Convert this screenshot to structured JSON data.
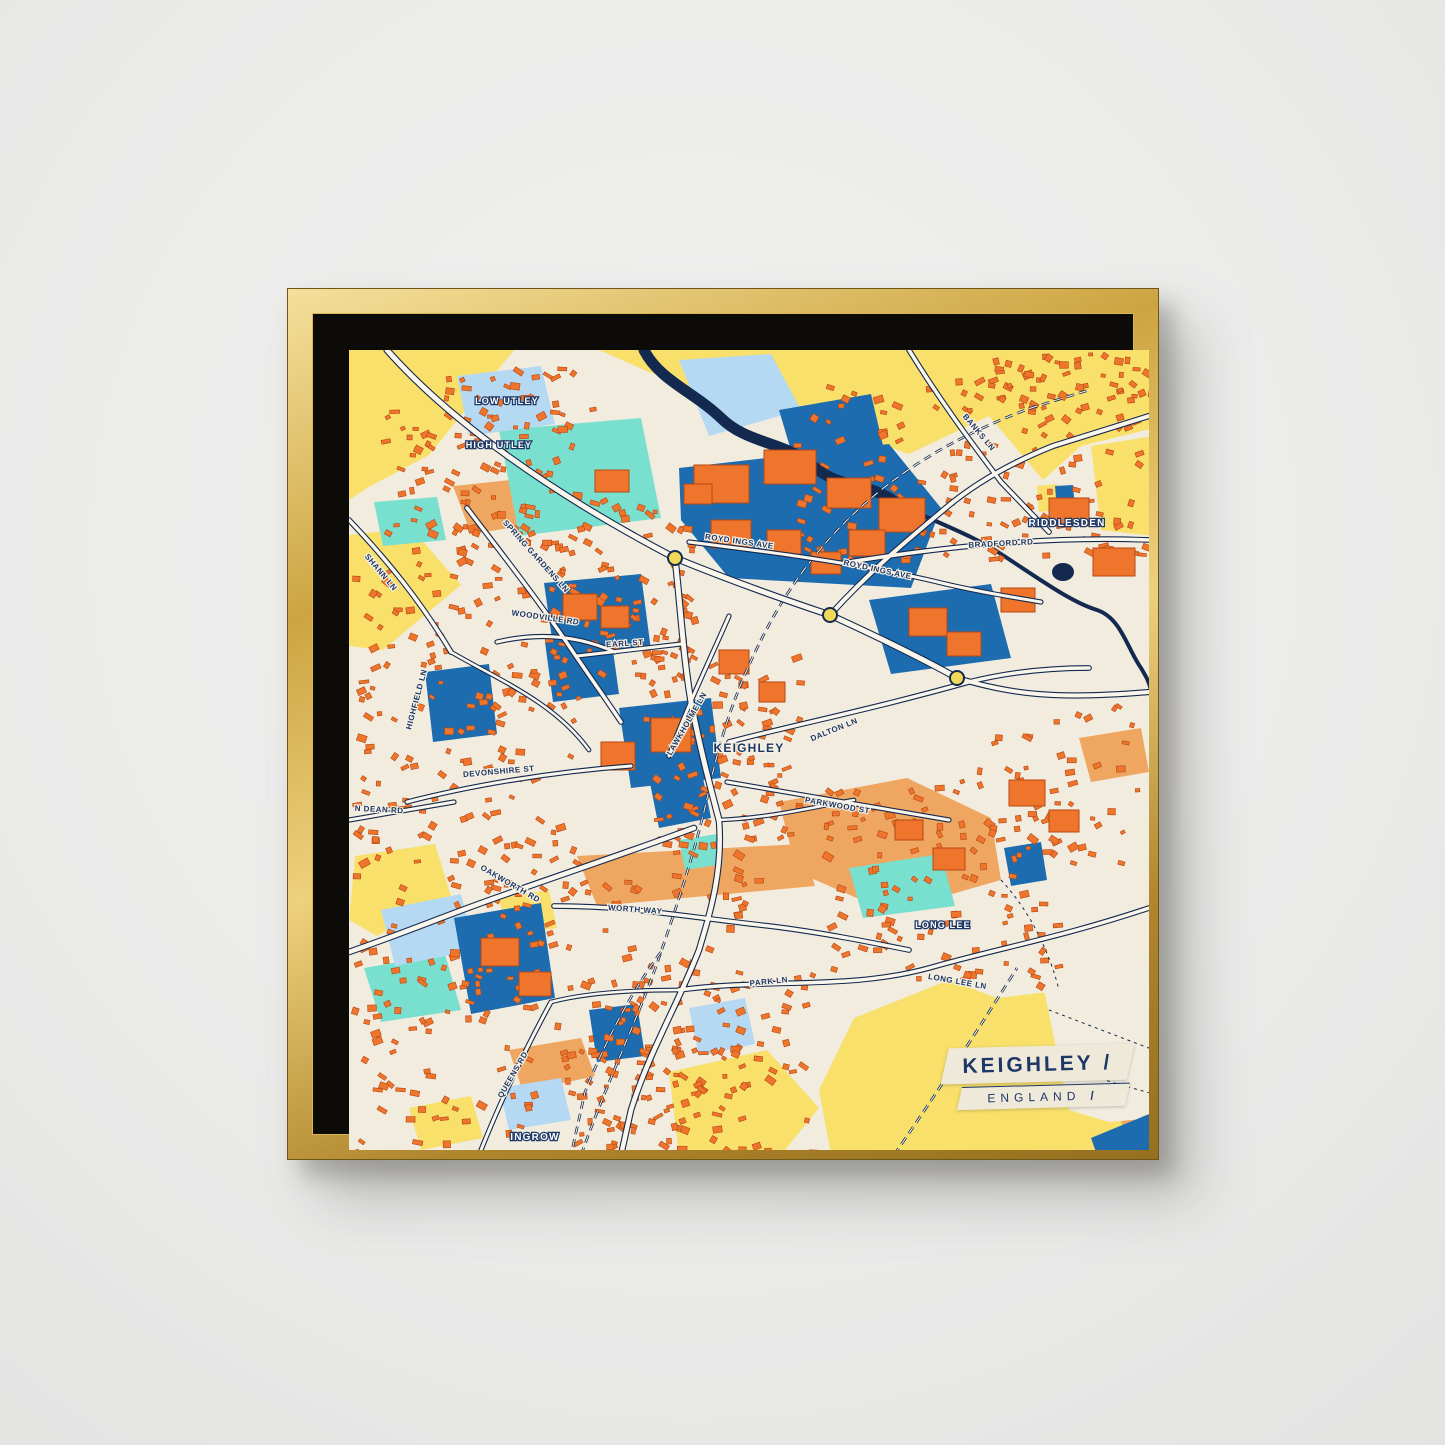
{
  "scene": {
    "wall_color": "#ebebea",
    "frame": {
      "gold_light": "#f4e09b",
      "gold_mid": "#cda441",
      "gold_dark": "#95701f",
      "float_gap_color": "#0d0b08"
    }
  },
  "map": {
    "palette": {
      "bg": "#f2ecdf",
      "yellow": "#f8e06a",
      "salmon": "#efa661",
      "aqua": "#79e0cf",
      "lightblue": "#b5d9f2",
      "blue": "#1e6cb0",
      "navy": "#13294f",
      "orange": "#ee752b",
      "orange_edge": "#b54713",
      "road": "#faf6ec",
      "roundabout": "#f2d957",
      "label_navy": "#1d3766",
      "halo": "#f6f1e4"
    },
    "regions": [
      {
        "c": "yellow",
        "p": "0,0 165,0 80,105 18,138 0,150"
      },
      {
        "c": "yellow",
        "p": "250,0 805,0 805,78 732,96 694,130 640,66 560,104 470,72 352,42 300,22"
      },
      {
        "c": "yellow",
        "p": "742,96 805,86 805,186 752,180"
      },
      {
        "c": "yellow",
        "p": "0,185 62,178 112,235 34,300 0,296"
      },
      {
        "c": "yellow",
        "p": "6,506 86,494 102,546 28,586 0,570"
      },
      {
        "c": "yellow",
        "p": "150,548 200,540 208,578 158,586"
      },
      {
        "c": "yellow",
        "p": "320,722 418,700 470,758 432,805 330,805"
      },
      {
        "c": "yellow",
        "p": "505,668 600,630 648,648 700,642 805,630 805,805 482,805 470,740"
      },
      {
        "c": "yellow",
        "p": "60,758 122,746 134,788 72,800"
      },
      {
        "c": "yellow",
        "p": "688,136 708,134 710,160 690,162"
      },
      {
        "c": "salmon",
        "p": "430,452 558,428 642,468 652,530 540,562 448,522"
      },
      {
        "c": "salmon",
        "p": "104,136 218,124 238,166 122,184"
      },
      {
        "c": "salmon",
        "p": "228,506 452,494 466,536 248,556"
      },
      {
        "c": "salmon",
        "p": "160,700 232,688 246,726 174,742"
      },
      {
        "c": "salmon",
        "p": "730,388 792,378 800,422 742,432"
      },
      {
        "c": "salmon",
        "p": "772,770 805,756 805,805 780,805"
      },
      {
        "c": "aqua",
        "p": "150,80 292,68 312,168 170,186"
      },
      {
        "c": "aqua",
        "p": "25,152 88,147 97,190 34,196"
      },
      {
        "c": "aqua",
        "p": "500,518 592,504 606,556 514,568"
      },
      {
        "c": "aqua",
        "p": "15,618 96,604 112,660 32,672"
      },
      {
        "c": "aqua",
        "p": "330,490 368,484 374,514 336,520"
      },
      {
        "c": "lightblue",
        "p": "330,10 422,4 452,60 360,86"
      },
      {
        "c": "lightblue",
        "p": "108,26 192,16 206,74 120,86"
      },
      {
        "c": "lightblue",
        "p": "32,560 112,544 126,600 46,616"
      },
      {
        "c": "lightblue",
        "p": "340,658 396,648 406,694 350,706"
      },
      {
        "c": "lightblue",
        "p": "150,738 212,728 222,770 160,780"
      },
      {
        "c": "bg",
        "p": "695,640 805,624 805,768 760,772 720,760"
      },
      {
        "c": "blue",
        "p": "330,118 540,94 592,158 562,238 380,228 332,170"
      },
      {
        "c": "blue",
        "p": "195,233 292,224 302,300 206,310"
      },
      {
        "c": "blue",
        "p": "520,250 642,234 662,308 542,324"
      },
      {
        "c": "blue",
        "p": "270,358 362,348 372,428 282,438"
      },
      {
        "c": "blue",
        "p": "105,568 192,553 206,648 122,664"
      },
      {
        "c": "blue",
        "p": "240,660 288,654 296,706 248,712"
      },
      {
        "c": "blue",
        "p": "430,60 522,44 536,104 446,114"
      },
      {
        "c": "blue",
        "p": "300,428 352,418 362,468 310,478"
      },
      {
        "c": "blue",
        "p": "706,136 724,135 726,158 708,160"
      },
      {
        "c": "blue",
        "p": "196,292 262,286 270,344 204,352"
      },
      {
        "c": "blue",
        "p": "76,322 140,314 148,384 84,392"
      },
      {
        "c": "blue",
        "p": "655,498 692,492 698,530 662,536"
      },
      {
        "c": "blue",
        "p": "742,788 805,762 805,805 748,805"
      }
    ],
    "water": [
      {
        "d": "M 295,0 C 310,30 345,42 372,68 C 398,94 438,92 464,116 C 492,140 520,132 546,152",
        "w": 11
      },
      {
        "d": "M 546,152 C 585,172 622,184 652,204 C 692,230 722,252 748,260 C 772,268 778,298 792,318 C 798,328 800,332 802,340",
        "w": 4
      }
    ],
    "water_spots": [
      {
        "cx": 448,
        "cy": 112,
        "rx": 16,
        "ry": 9
      },
      {
        "cx": 714,
        "cy": 222,
        "rx": 11,
        "ry": 9
      }
    ],
    "railways": [
      {
        "d": "M 232,805 C 262,722 292,662 312,602 C 336,532 352,480 362,430 C 376,370 392,330 412,290 C 442,230 482,180 532,140 C 572,108 622,80 682,58 L 740,40"
      },
      {
        "d": "M 312,602 C 282,642 256,692 236,742 L 222,805"
      },
      {
        "d": "M 545,805 C 590,740 630,678 668,618"
      }
    ],
    "trails": [
      {
        "d": "M 700,660 L 805,700"
      },
      {
        "d": "M 680,700 C 720,720 760,732 805,744"
      },
      {
        "d": "M 652,530 C 680,560 700,600 710,640"
      }
    ],
    "roads": [
      {
        "d": "M 38,0 C 100,70 200,142 326,208",
        "w": 5
      },
      {
        "d": "M 326,208 C 380,230 430,248 481,265",
        "w": 5
      },
      {
        "d": "M 481,265 C 540,292 576,310 608,328",
        "w": 5
      },
      {
        "d": "M 608,328 C 662,344 706,350 800,342",
        "w": 4
      },
      {
        "d": "M 481,265 C 520,222 556,192 592,162 C 624,134 664,112 704,96 L 800,66",
        "w": 4
      },
      {
        "d": "M 500,212 C 600,196 700,186 800,190",
        "w": 3.5
      },
      {
        "d": "M 560,0 C 592,52 622,92 652,132 L 700,182",
        "w": 3.5
      },
      {
        "d": "M 326,208 C 332,262 334,304 342,352 C 352,402 360,432 370,470",
        "w": 5
      },
      {
        "d": "M 370,470 C 374,520 362,560 350,600 C 330,652 300,702 282,760 L 272,805",
        "w": 4.5
      },
      {
        "d": "M 345,478 C 280,502 220,522 152,546 C 100,564 58,582 0,602",
        "w": 4.5
      },
      {
        "d": "M 205,556 C 282,556 330,566 420,576 C 470,582 520,592 560,600",
        "w": 3.5
      },
      {
        "d": "M 330,640 C 420,628 500,640 580,618 C 650,598 710,588 800,558",
        "w": 3.5
      },
      {
        "d": "M 380,392 C 440,376 520,360 620,332 C 660,322 700,318 740,318",
        "w": 3.5
      },
      {
        "d": "M 118,158 C 150,200 186,246 216,290 C 236,320 252,342 272,372",
        "w": 3.5
      },
      {
        "d": "M 0,170 C 40,212 72,252 102,302",
        "w": 3.5
      },
      {
        "d": "M 148,292 C 190,282 230,286 266,302",
        "w": 3
      },
      {
        "d": "M 228,306 L 332,294",
        "w": 3
      },
      {
        "d": "M 320,406 C 340,352 360,312 380,266",
        "w": 3
      },
      {
        "d": "M 58,452 C 120,436 200,422 282,416",
        "w": 3
      },
      {
        "d": "M 0,470 L 105,452",
        "w": 3
      },
      {
        "d": "M 132,800 C 152,750 176,700 202,652",
        "w": 3
      },
      {
        "d": "M 340,192 C 420,202 500,212 580,230 C 620,240 656,246 692,252",
        "w": 3
      },
      {
        "d": "M 378,432 C 440,442 520,456 600,470",
        "w": 3
      },
      {
        "d": "M 102,302 C 150,330 205,352 240,400",
        "w": 2.5
      },
      {
        "d": "M 202,652 C 240,642 290,640 330,640",
        "w": 2.5
      },
      {
        "d": "M 370,470 C 420,468 460,458 505,450",
        "w": 2.5
      }
    ],
    "factories": [
      [
        345,
        115,
        55,
        38
      ],
      [
        415,
        100,
        52,
        34
      ],
      [
        478,
        128,
        44,
        30
      ],
      [
        362,
        170,
        40,
        28
      ],
      [
        530,
        148,
        46,
        34
      ],
      [
        500,
        180,
        36,
        26
      ],
      [
        560,
        258,
        38,
        28
      ],
      [
        598,
        282,
        34,
        24
      ],
      [
        214,
        244,
        34,
        26
      ],
      [
        252,
        256,
        28,
        22
      ],
      [
        302,
        368,
        40,
        34
      ],
      [
        252,
        392,
        34,
        28
      ],
      [
        132,
        588,
        38,
        28
      ],
      [
        170,
        622,
        32,
        24
      ],
      [
        700,
        148,
        40,
        28
      ],
      [
        744,
        198,
        42,
        28
      ],
      [
        652,
        238,
        34,
        24
      ],
      [
        546,
        470,
        28,
        20
      ],
      [
        584,
        498,
        32,
        22
      ],
      [
        418,
        180,
        34,
        24
      ],
      [
        462,
        202,
        30,
        22
      ],
      [
        370,
        300,
        30,
        24
      ],
      [
        410,
        332,
        26,
        20
      ],
      [
        246,
        120,
        34,
        22
      ],
      [
        335,
        134,
        28,
        20
      ],
      [
        660,
        430,
        36,
        26
      ],
      [
        700,
        460,
        30,
        22
      ]
    ],
    "clusters": [
      {
        "x": 30,
        "y": 14,
        "w": 215,
        "h": 185,
        "n": 110,
        "s": 11
      },
      {
        "x": 2,
        "y": 190,
        "w": 225,
        "h": 325,
        "n": 170,
        "s": 22
      },
      {
        "x": 228,
        "y": 150,
        "w": 115,
        "h": 175,
        "n": 70,
        "s": 33
      },
      {
        "x": 284,
        "y": 300,
        "w": 165,
        "h": 195,
        "n": 95,
        "s": 44
      },
      {
        "x": 432,
        "y": 28,
        "w": 370,
        "h": 180,
        "n": 150,
        "s": 55
      },
      {
        "x": 470,
        "y": 430,
        "w": 240,
        "h": 205,
        "n": 120,
        "s": 66
      },
      {
        "x": 152,
        "y": 498,
        "w": 255,
        "h": 300,
        "n": 150,
        "s": 77
      },
      {
        "x": 2,
        "y": 522,
        "w": 148,
        "h": 280,
        "n": 85,
        "s": 88
      },
      {
        "x": 238,
        "y": 618,
        "w": 225,
        "h": 182,
        "n": 85,
        "s": 99
      },
      {
        "x": 625,
        "y": 352,
        "w": 165,
        "h": 165,
        "n": 40,
        "s": 101
      },
      {
        "x": 640,
        "y": 2,
        "w": 160,
        "h": 58,
        "n": 40,
        "s": 112
      }
    ],
    "roundabouts": [
      [
        326,
        208
      ],
      [
        481,
        265
      ],
      [
        608,
        328
      ]
    ],
    "road_labels": [
      {
        "text": "BANKS LN",
        "x": 628,
        "y": 84,
        "angle": 50
      },
      {
        "text": "BRADFORD RD",
        "x": 652,
        "y": 196,
        "angle": -3
      },
      {
        "text": "ROYD INGS AVE",
        "x": 390,
        "y": 194,
        "angle": 8
      },
      {
        "text": "ROYD INGS AVE",
        "x": 528,
        "y": 222,
        "angle": 12
      },
      {
        "text": "SPRING GARDENS LN",
        "x": 185,
        "y": 208,
        "angle": 48
      },
      {
        "text": "SHANN LN",
        "x": 30,
        "y": 224,
        "angle": 50
      },
      {
        "text": "WOODVILLE RD",
        "x": 196,
        "y": 270,
        "angle": 8
      },
      {
        "text": "EARL ST",
        "x": 276,
        "y": 296,
        "angle": -4
      },
      {
        "text": "LAWKHOLME LN",
        "x": 340,
        "y": 375,
        "angle": -60
      },
      {
        "text": "DALTON LN",
        "x": 486,
        "y": 382,
        "angle": -22
      },
      {
        "text": "HIGHFIELD LN",
        "x": 70,
        "y": 350,
        "angle": -75
      },
      {
        "text": "DEVONSHIRE ST",
        "x": 150,
        "y": 424,
        "angle": -5
      },
      {
        "text": "N DEAN RD",
        "x": 30,
        "y": 462,
        "angle": 3
      },
      {
        "text": "PARKWOOD ST",
        "x": 488,
        "y": 458,
        "angle": 10
      },
      {
        "text": "OAKWORTH RD",
        "x": 160,
        "y": 536,
        "angle": 30
      },
      {
        "text": "WORTH WAY",
        "x": 286,
        "y": 562,
        "angle": 4
      },
      {
        "text": "QUEENS RD",
        "x": 166,
        "y": 726,
        "angle": -60
      },
      {
        "text": "PARK LN",
        "x": 420,
        "y": 634,
        "angle": -6
      },
      {
        "text": "LONG LEE LN",
        "x": 608,
        "y": 634,
        "angle": 10
      }
    ],
    "place_labels": [
      {
        "text": "LOW UTLEY",
        "x": 158,
        "y": 54,
        "size": 9,
        "town": false
      },
      {
        "text": "HIGH UTLEY",
        "x": 150,
        "y": 98,
        "size": 9,
        "town": false
      },
      {
        "text": "RIDDLESDEN",
        "x": 718,
        "y": 176,
        "size": 10,
        "town": false
      },
      {
        "text": "KEIGHLEY",
        "x": 400,
        "y": 402,
        "size": 12,
        "town": true
      },
      {
        "text": "LONG LEE",
        "x": 594,
        "y": 578,
        "size": 9,
        "town": false
      },
      {
        "text": "INGROW",
        "x": 186,
        "y": 790,
        "size": 10,
        "town": false
      }
    ],
    "title_card": {
      "title": "KEIGHLEY",
      "subtitle": "ENGLAND",
      "slash": "/"
    }
  }
}
